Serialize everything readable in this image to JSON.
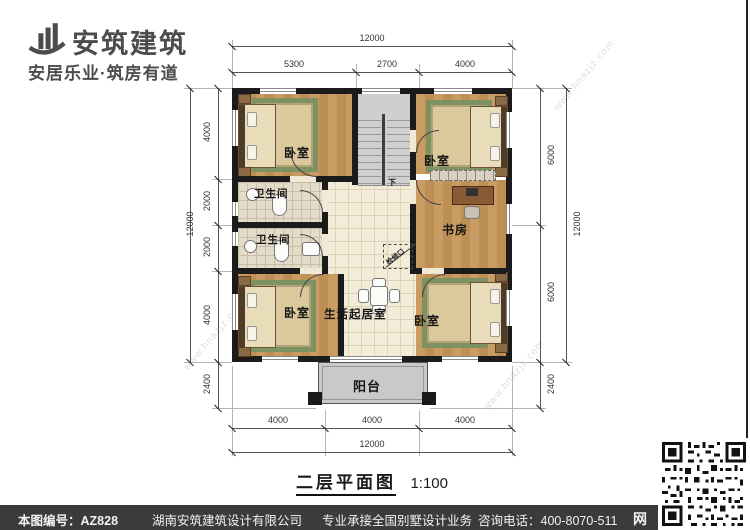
{
  "header": {
    "brand": "安筑建筑",
    "tagline": "安居乐业·筑房有道"
  },
  "plan": {
    "rooms": [
      {
        "id": "bedroom-top-left",
        "label": "卧室"
      },
      {
        "id": "bathroom-upper",
        "label": "卫生间"
      },
      {
        "id": "bathroom-lower",
        "label": "卫生间"
      },
      {
        "id": "bedroom-bottom-left",
        "label": "卧室"
      },
      {
        "id": "living-room",
        "label": "生活起居室"
      },
      {
        "id": "bedroom-top-right",
        "label": "卧室"
      },
      {
        "id": "study",
        "label": "书房"
      },
      {
        "id": "bedroom-bottom-right",
        "label": "卧室"
      },
      {
        "id": "balcony",
        "label": "阳台"
      }
    ],
    "stair_down": "下",
    "access_hatch": "检修口",
    "dims": {
      "top_total": "12000",
      "top_segs": [
        "5300",
        "2700",
        "4000"
      ],
      "left_total": "12000",
      "left_segs": [
        "4000",
        "2000",
        "2000",
        "4000"
      ],
      "left_below": "2400",
      "right_total": "12000",
      "right_segs": [
        "6000",
        "6000"
      ],
      "right_below": "2400",
      "bottom_total": "12000",
      "bottom_segs": [
        "4000",
        "4000",
        "4000"
      ]
    }
  },
  "title": {
    "text": "二层平面图",
    "scale": "1:100"
  },
  "footer": {
    "number": "本图编号：AZ828",
    "company": "湖南安筑建筑设计有限公司",
    "service": "专业承接全国别墅设计业务",
    "phone": "咨询电话：400-8070-511",
    "web_glyph": "网"
  },
  "watermark": {
    "text": "www.hnazjz.com"
  }
}
